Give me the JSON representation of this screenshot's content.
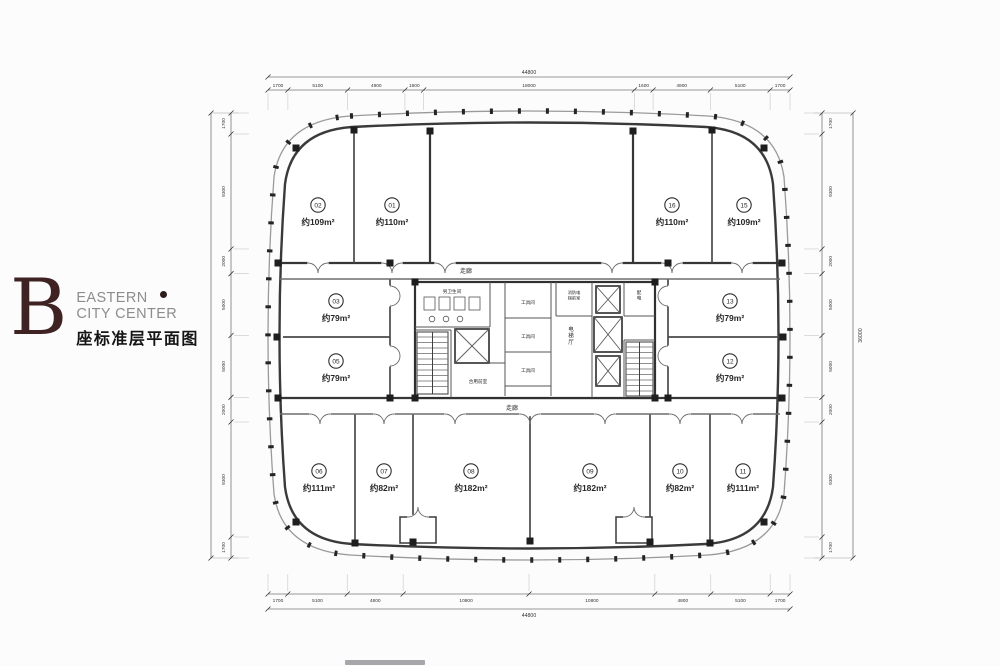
{
  "branding": {
    "letter": "B",
    "line1": "EASTERN",
    "line2": "CITY CENTER",
    "subtitle": "座标准层平面图",
    "letter_color": "#3f2222",
    "dot_color": "#2e1c1c"
  },
  "plan": {
    "rooms": [
      {
        "num": "01",
        "area": "约110m²"
      },
      {
        "num": "02",
        "area": "约109m²"
      },
      {
        "num": "03",
        "area": "约79m²"
      },
      {
        "num": "05",
        "area": "约79m²"
      },
      {
        "num": "06",
        "area": "约111m²"
      },
      {
        "num": "07",
        "area": "约82m²"
      },
      {
        "num": "08",
        "area": "约182m²"
      },
      {
        "num": "09",
        "area": "约182m²"
      },
      {
        "num": "10",
        "area": "约82m²"
      },
      {
        "num": "11",
        "area": "约111m²"
      },
      {
        "num": "12",
        "area": "约79m²"
      },
      {
        "num": "13",
        "area": "约79m²"
      },
      {
        "num": "15",
        "area": "约109m²"
      },
      {
        "num": "16",
        "area": "约110m²"
      }
    ],
    "core_labels": {
      "corridor_top": "走廊",
      "corridor_bottom": "走廊",
      "mens_toilet": "男卫生间",
      "tool_room_1": "工具间",
      "tool_room_2": "工具间",
      "tool_room_3": "工具间",
      "elevator_hall": "电梯厅",
      "fire_elevator_lobby": "消防电梯前室",
      "shared_lobby": "合用前室",
      "power_room": "配电"
    },
    "dimensions": {
      "top_total": "44800",
      "top_segments": [
        "1700",
        "5100",
        "4900",
        "1600",
        "18000",
        "1600",
        "4900",
        "5100",
        "1700"
      ],
      "bottom_total": "44800",
      "bottom_segments": [
        "1700",
        "5100",
        "4800",
        "10800",
        "10800",
        "4800",
        "5100",
        "1700"
      ],
      "left_segments": [
        "1700",
        "9300",
        "2000",
        "5000",
        "5000",
        "2000",
        "9300",
        "1700"
      ],
      "right_segments": [
        "1700",
        "9300",
        "2000",
        "5000",
        "5000",
        "2000",
        "9300",
        "1700"
      ],
      "right_total": "36000"
    },
    "line_color": "#363636"
  }
}
